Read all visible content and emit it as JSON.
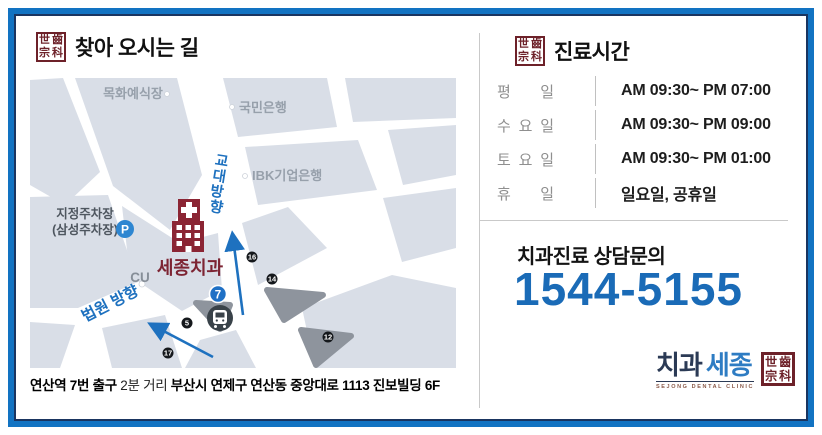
{
  "brand": {
    "seal_chars": [
      "世",
      "齒",
      "宗",
      "科"
    ],
    "logo_word1": "치과",
    "logo_word2": "세종",
    "logo_subtext": "SEJONG DENTAL CLINIC"
  },
  "colors": {
    "frame_blue": "#1273c2",
    "frame_navy": "#1a3560",
    "accent_blue": "#1e71bf",
    "phone_blue": "#1a6bb7",
    "brand_red": "#6d2129",
    "building_red": "#8b2534",
    "map_block": "#d9dee7",
    "map_gray": "#8e949d"
  },
  "directions": {
    "title": "찾아 오시는 길",
    "address_parts": [
      {
        "text": "연산역 7번 출구",
        "bold": true
      },
      {
        "text": " 2분 거리 ",
        "bold": false
      },
      {
        "text": "부산시 연제구 연산동 중앙대로 1113 진보빌딩 6F",
        "bold": true
      }
    ]
  },
  "map": {
    "landmarks": {
      "wedding_hall": "목화예식장",
      "kookmin_bank": "국민은행",
      "ibk_bank": "IBK기업은행",
      "parking_line1": "지정주차장",
      "parking_line2": "(삼성주차장)",
      "cu": "CU",
      "clinic": "세종치과"
    },
    "direction_gyodae_chars": [
      "교",
      "대",
      "방",
      "향"
    ],
    "direction_court": "법원 방향",
    "parking_badge": "P",
    "subway_exit_badge": "7",
    "exit_numbers": [
      "16",
      "14",
      "5",
      "12",
      "17"
    ]
  },
  "hours": {
    "title": "진료시간",
    "rows": [
      {
        "day": "평일",
        "time": "AM 09:30~ PM 07:00"
      },
      {
        "day": "수요일",
        "time": "AM 09:30~ PM 09:00"
      },
      {
        "day": "토요일",
        "time": "AM 09:30~ PM 01:00"
      },
      {
        "day": "휴일",
        "time": "일요일, 공휴일"
      }
    ]
  },
  "contact": {
    "label": "치과진료 상담문의",
    "phone": "1544-5155"
  }
}
